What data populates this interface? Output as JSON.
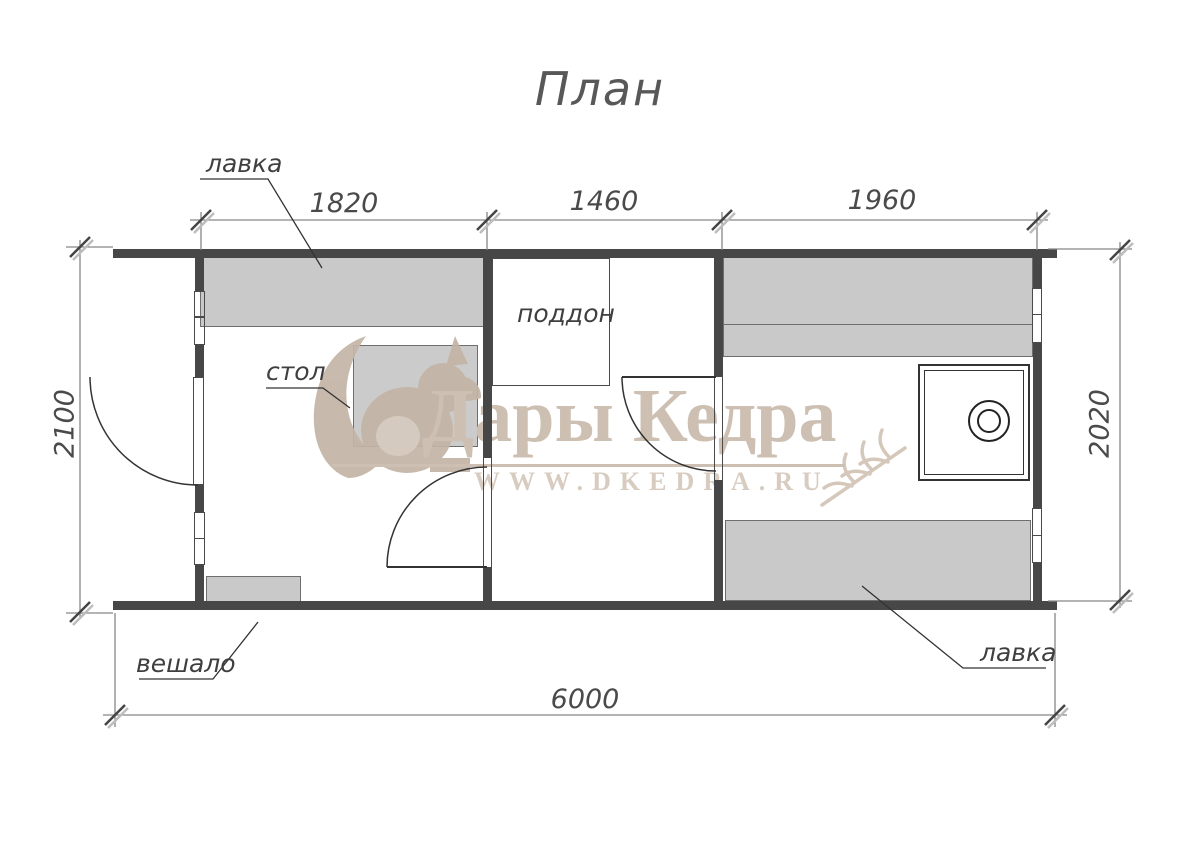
{
  "title": "План",
  "dimensions": {
    "top": {
      "room1_width": "1820",
      "room2_width": "1460",
      "room3_width": "1960"
    },
    "left_height": "2100",
    "right_height": "2020",
    "bottom_total": "6000"
  },
  "labels": {
    "bench_top": "лавка",
    "table": "стол",
    "shower_tray": "поддон",
    "hanger": "вешало",
    "bench_bottom": "лавка"
  },
  "watermark": {
    "brand": "Дары Кедра",
    "url": "WWW.DKEDRA.RU"
  },
  "colors": {
    "wall": "#474747",
    "furniture_fill": "#c9c9c9",
    "line": "#4a4a4a",
    "dimension_line": "#888888",
    "watermark": "#cdc0b2"
  }
}
